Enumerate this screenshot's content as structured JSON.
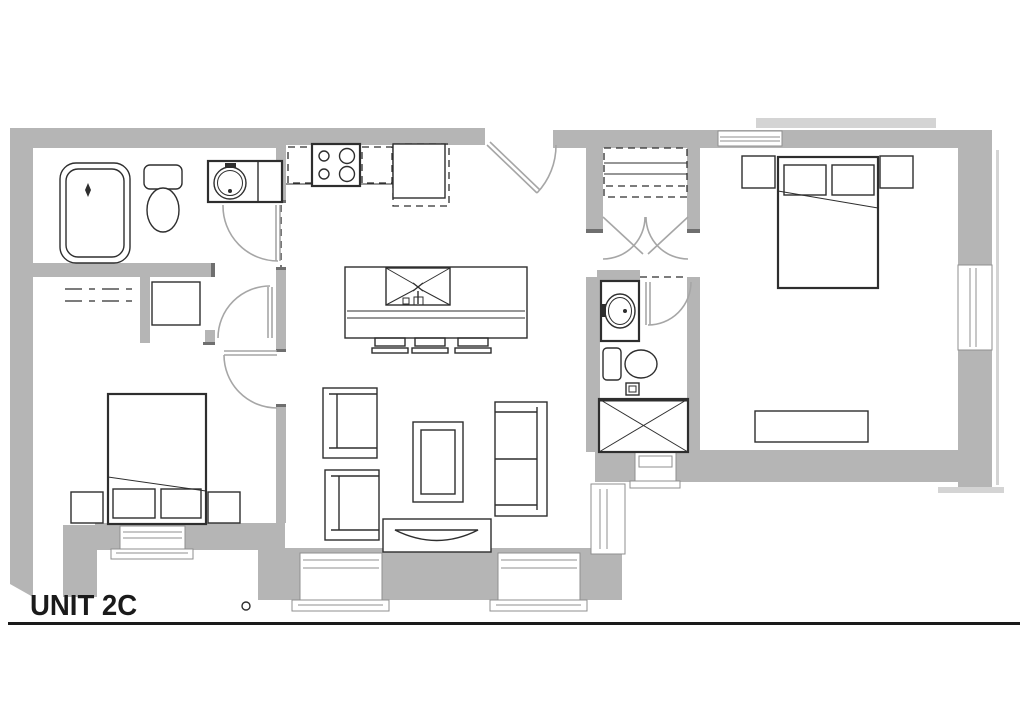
{
  "title": {
    "label": "UNIT 2C"
  },
  "colors": {
    "background": "#ffffff",
    "wall": "#b5b5b5",
    "wall_light": "#d4d4d4",
    "cap": "#6f6f6f",
    "line": "#2e2e2e",
    "door": "#a6a6a6",
    "window_frame": "#8f8f8f",
    "text": "#1a1a1a"
  }
}
